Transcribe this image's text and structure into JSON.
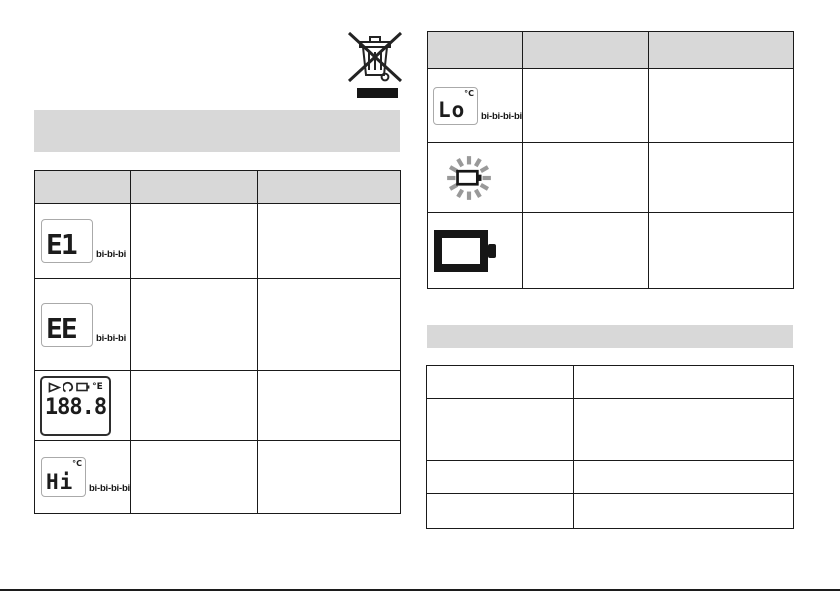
{
  "page": {
    "background": "#ffffff"
  },
  "weee": {
    "symbol": "crossed-out-wheelie-bin"
  },
  "left_panel": {
    "section_header": "",
    "table": {
      "headers": [
        "",
        "",
        ""
      ],
      "rows": [
        {
          "lcd": "E1",
          "beep": "bi-bi-bi",
          "col2": "",
          "col3": ""
        },
        {
          "lcd": "EE",
          "beep": "bi-bi-bi",
          "col2": "",
          "col3": ""
        },
        {
          "lcd": "188.8",
          "unit": "°E",
          "col2": "",
          "col3": ""
        },
        {
          "lcd": "Hi",
          "unit": "°C",
          "beep": "bi-bi-bi-bi",
          "col2": "",
          "col3": ""
        }
      ]
    }
  },
  "right_panel": {
    "table": {
      "headers": [
        "",
        "",
        ""
      ],
      "rows": [
        {
          "lcd": "Lo",
          "unit": "°C",
          "beep": "bi-bi-bi-bi",
          "col2": "",
          "col3": ""
        },
        {
          "icon": "battery-blinking",
          "col2": "",
          "col3": ""
        },
        {
          "icon": "battery-solid",
          "col2": "",
          "col3": ""
        }
      ]
    },
    "section_header": "",
    "spec_table": {
      "rows": [
        {
          "col1": "",
          "col2": ""
        },
        {
          "col1": "",
          "col2": ""
        },
        {
          "col1": "",
          "col2": ""
        },
        {
          "col1": "",
          "col2": ""
        }
      ]
    }
  },
  "colors": {
    "header_fill": "#d8d8d8",
    "table_border": "#1a1a1a",
    "lcd_box_border": "#aaaaaa",
    "blink_ray_gray": "#999999",
    "ink": "#1c1c1c"
  }
}
